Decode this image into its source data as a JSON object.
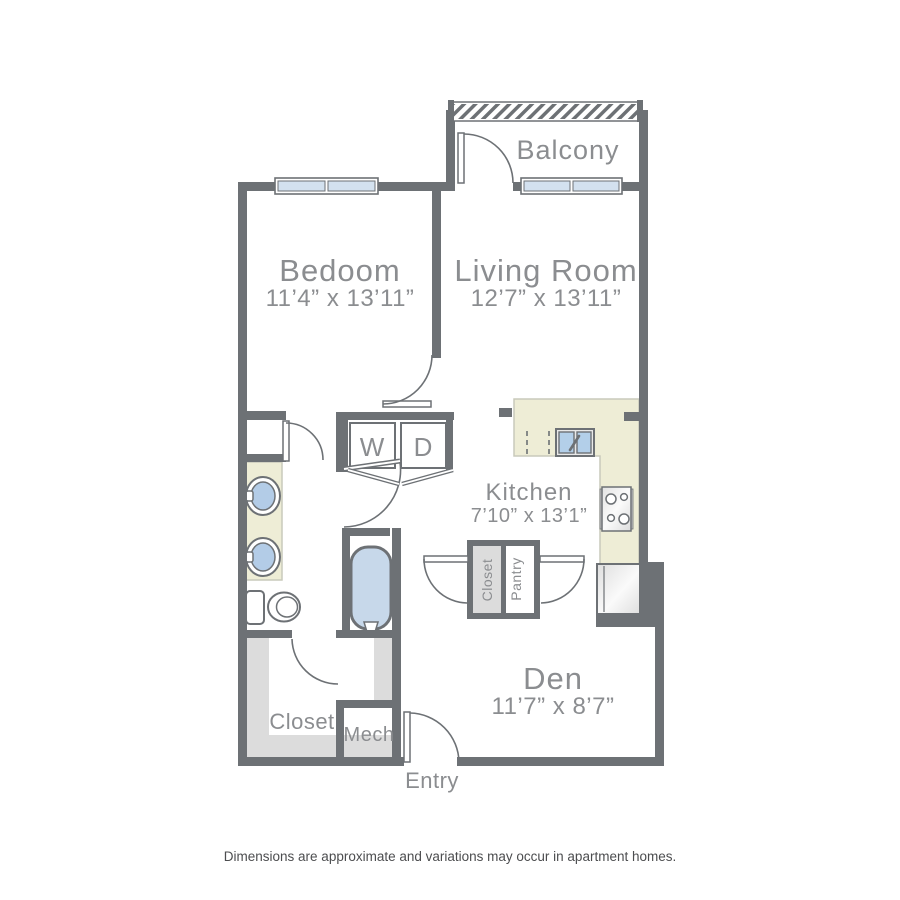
{
  "floorplan": {
    "balcony": {
      "label": "Balcony"
    },
    "bedroom": {
      "label": "Bedoom",
      "dims": "11’4” x 13’11”"
    },
    "living_room": {
      "label": "Living Room",
      "dims": "12’7” x 13’11”"
    },
    "kitchen": {
      "label": "Kitchen",
      "dims": "7’10” x 13’1”"
    },
    "den": {
      "label": "Den",
      "dims": "11’7” x 8’7”"
    },
    "walkin_closet": {
      "label": "Closet"
    },
    "mech": {
      "label": "Mech"
    },
    "entry": {
      "label": "Entry"
    },
    "hall_closet": {
      "label": "Closet"
    },
    "pantry": {
      "label": "Pantry"
    },
    "washer": {
      "label": "W"
    },
    "dryer": {
      "label": "D"
    },
    "disclaimer": "Dimensions are approximate and variations may occur in apartment homes.",
    "colors": {
      "wall": "#6d7175",
      "label_gray": "#8b8d90",
      "counter_beige": "#eeedd6",
      "fixture_blue": "#b3cce7",
      "window_blue": "#d3e1ef",
      "tub_blue": "#c7d8ea",
      "shelf_gray": "#dcdcdc",
      "disclaimer_text": "#4c4d4f"
    }
  }
}
